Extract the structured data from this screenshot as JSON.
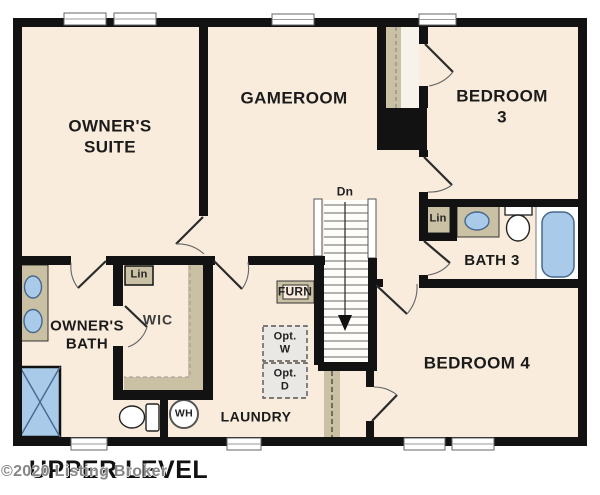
{
  "colors": {
    "wall": "#121212",
    "cream": "#f9ecdc",
    "strip": "#f8f3ea",
    "tan": "#cac1a4",
    "blue": "#a9cae8",
    "blue-border": "#47688c",
    "opt-fill": "#e9e8e4",
    "watermark": "#868686",
    "text": "#1b1b1b"
  },
  "plan": {
    "title": "UPPER LEVEL",
    "watermark": "©2020 Listing Broker",
    "rooms": {
      "owners_suite": "OWNER'S\nSUITE",
      "gameroom": "GAMEROOM",
      "bedroom3": "BEDROOM 3",
      "bedroom4": "BEDROOM 4",
      "bath3": "BATH 3",
      "owners_bath": "OWNER'S\nBATH",
      "wic": "WIC",
      "laundry": "LAUNDRY"
    },
    "annotations": {
      "lin_wic": "Lin",
      "lin_bath": "Lin",
      "furnace": "FURN",
      "opt_washer": "Opt.\nW",
      "opt_dryer": "Opt.\nD",
      "stairs_down": "Dn",
      "water_heater": "WH"
    }
  }
}
